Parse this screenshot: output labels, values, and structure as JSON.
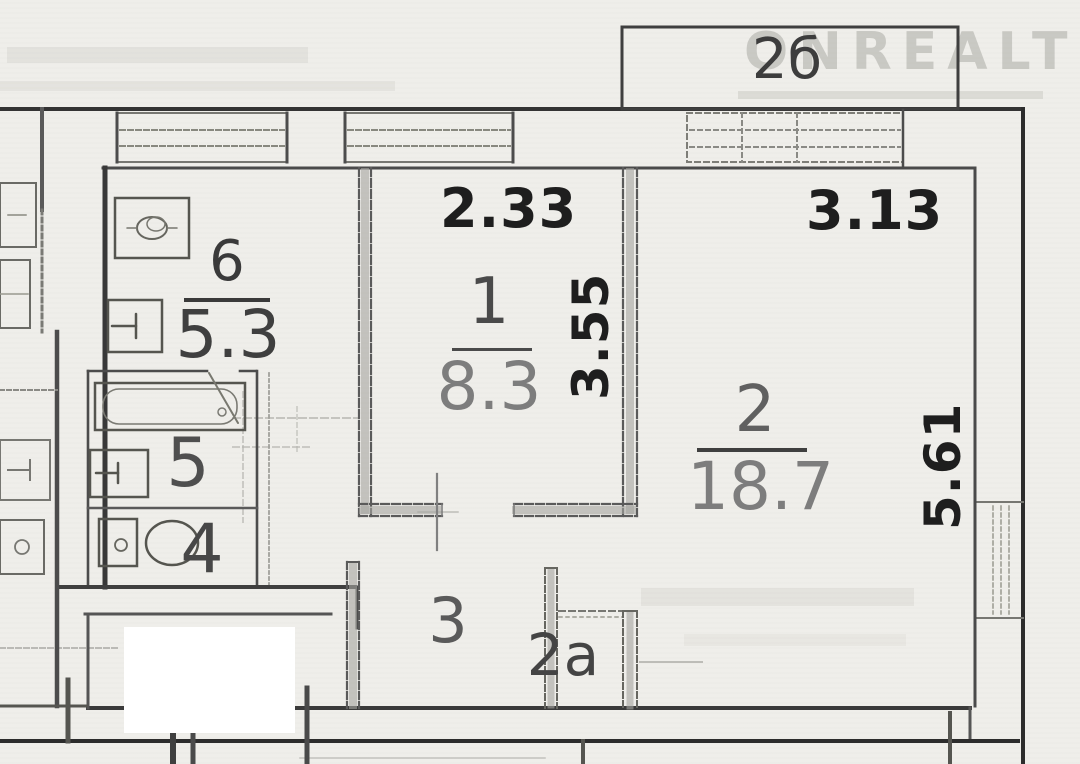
{
  "document_type": "apartment-floor-plan-scan",
  "watermark": {
    "text": "ONREALT"
  },
  "rooms": [
    {
      "id": "room-1",
      "number": "1",
      "area": "8.3"
    },
    {
      "id": "room-2",
      "number": "2",
      "area": "18.7"
    },
    {
      "id": "kitchen",
      "number": "6",
      "area": "5.3"
    },
    {
      "id": "bathroom",
      "number": "5"
    },
    {
      "id": "wc",
      "number": "4"
    },
    {
      "id": "hallway",
      "number": "3"
    },
    {
      "id": "closet",
      "number": "2а"
    },
    {
      "id": "balcony",
      "number": "2б"
    }
  ],
  "dimensions": [
    {
      "label": "2.33",
      "for": "room-1",
      "edge": "top",
      "rotated": false
    },
    {
      "label": "3.13",
      "for": "room-2",
      "edge": "top",
      "rotated": false
    },
    {
      "label": "3.55",
      "for": "room-1",
      "edge": "right",
      "rotated": true
    },
    {
      "label": "5.61",
      "for": "room-2",
      "edge": "right",
      "rotated": true
    }
  ],
  "icons": [
    "stove-icon",
    "sink-icon",
    "bathtub-icon",
    "washbasin-icon",
    "toilet-icon",
    "door-swing-icon"
  ],
  "colors": {
    "paper": "#efeeea",
    "wall_dark": "#2c2c2c",
    "wall_medium": "#555555",
    "dimension_text": "#1e1e1e",
    "area_text": "#7d7d7d",
    "watermark": "#a4a49d"
  }
}
